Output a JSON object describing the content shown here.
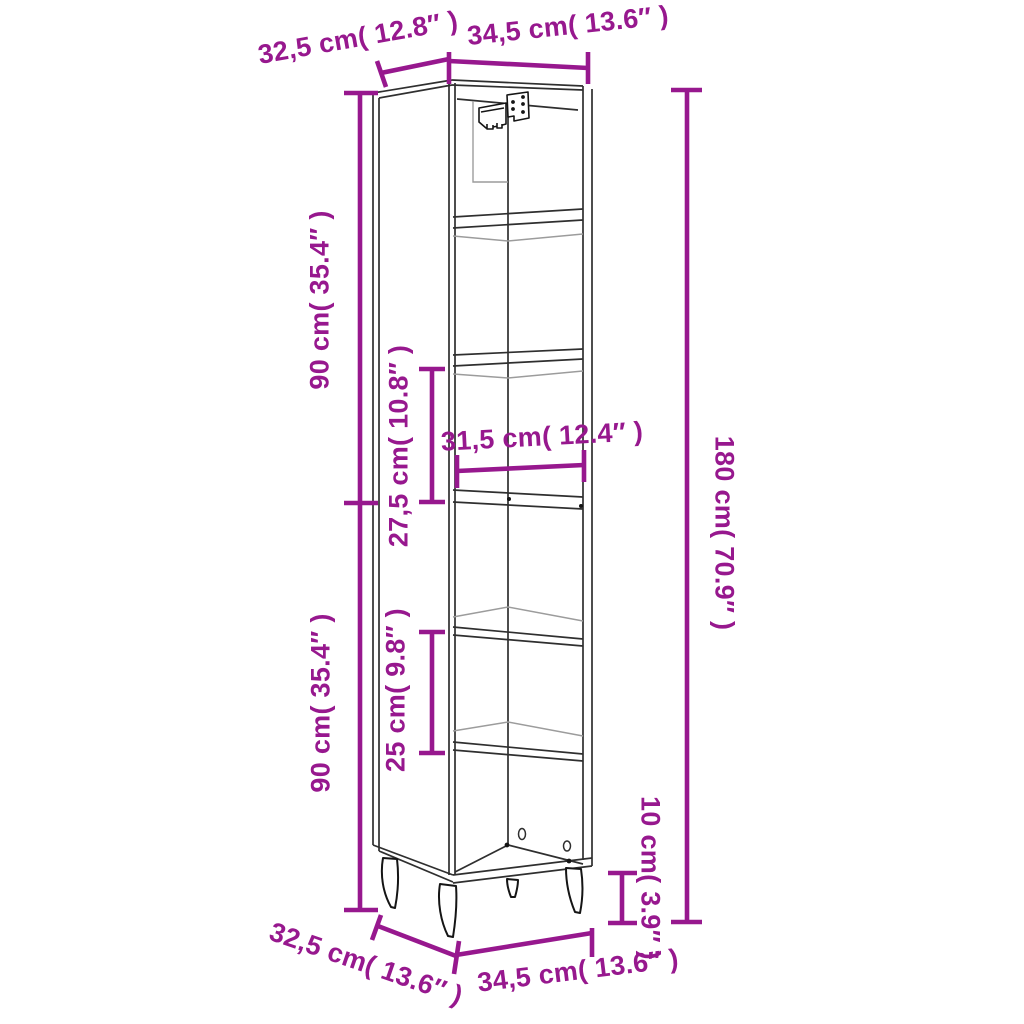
{
  "colors": {
    "accent": "#97188E",
    "line_dark": "#2F2F2F",
    "line_light": "#9C9C9C",
    "hinge": "#151515",
    "background": "#FFFFFF"
  },
  "diagram": {
    "subject": "tall-narrow-cabinet-with-shelves-and-legs",
    "view": "three-quarter line drawing with dimension annotations"
  },
  "measurements": {
    "top_depth": {
      "text": "32,5 cm( 12.8″ )",
      "cm": "32,5",
      "in": "12.8"
    },
    "top_width": {
      "text": "34,5 cm( 13.6″ )",
      "cm": "34,5",
      "in": "13.6"
    },
    "upper_height": {
      "text": "90 cm( 35.4″ )",
      "cm": "90",
      "in": "35.4"
    },
    "lower_height": {
      "text": "90 cm( 35.4″ )",
      "cm": "90",
      "in": "35.4"
    },
    "upper_gap": {
      "text": "27,5 cm( 10.8″ )",
      "cm": "27,5",
      "in": "10.8"
    },
    "inner_width": {
      "text": "31,5 cm( 12.4″ )",
      "cm": "31,5",
      "in": "12.4"
    },
    "lower_gap": {
      "text": "25 cm( 9.8″ )",
      "cm": "25",
      "in": "9.8"
    },
    "total_height": {
      "text": "180 cm( 70.9″ )",
      "cm": "180",
      "in": "70.9"
    },
    "leg_height": {
      "text": "10 cm( 3.9″ )",
      "cm": "10",
      "in": "3.9"
    },
    "bottom_depth": {
      "text": "32,5 cm( 13.6″ )",
      "cm": "32,5",
      "in": "13.6"
    },
    "bottom_width": {
      "text": "34,5 cm( 13.6″ )",
      "cm": "34,5",
      "in": "13.6"
    }
  }
}
